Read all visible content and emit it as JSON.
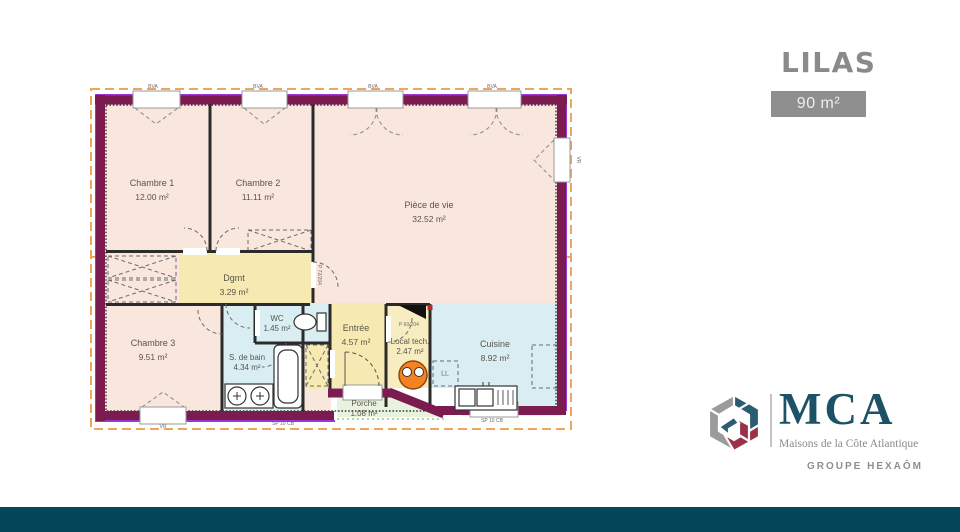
{
  "header": {
    "title": "LILAS",
    "area_badge": "90 m²"
  },
  "branding": {
    "name": "MCA",
    "tagline": "Maisons de la Côte Atlantique",
    "group": "GROUPE HEXAÔM"
  },
  "floorplan": {
    "rooms": [
      {
        "id": "chambre1",
        "name": "Chambre 1",
        "area": "12.00 m²"
      },
      {
        "id": "chambre2",
        "name": "Chambre 2",
        "area": "11.11 m²"
      },
      {
        "id": "piece-de-vie",
        "name": "Pièce de vie",
        "area": "32.52 m²"
      },
      {
        "id": "dgmt",
        "name": "Dgmt",
        "area": "3.29 m²"
      },
      {
        "id": "wc",
        "name": "WC",
        "area": "1.45 m²"
      },
      {
        "id": "chambre3",
        "name": "Chambre 3",
        "area": "9.51 m²"
      },
      {
        "id": "salle-de-bain",
        "name": "S. de bain",
        "area": "4.34 m²"
      },
      {
        "id": "entree",
        "name": "Entrée",
        "area": "4.57 m²"
      },
      {
        "id": "local-tech",
        "name": "Local tech.",
        "area": "2.47 m²"
      },
      {
        "id": "cuisine",
        "name": "Cuisine",
        "area": "8.92 m²"
      },
      {
        "id": "porche",
        "name": "Porche",
        "area": "1.08 m²"
      }
    ],
    "annotations": {
      "shutter": "BVA",
      "roller": "VR",
      "slab": "SP 10 CB",
      "door_size": "P 72/204",
      "door_size_small": "P 60/204",
      "washer": "LL"
    }
  },
  "colors": {
    "footer_teal": "#05465a",
    "title_gray": "#8a8a8a",
    "badge_bg": "#8f8f8f",
    "brand_blue": "#1d5266",
    "wall_maroon": "#7b1b50",
    "wall_outline_violet": "#9a35d8",
    "room_pink": "#f9e6dd",
    "room_yellow": "#f6eab2",
    "room_blue": "#d9eef3",
    "room_green": "#e7f3de",
    "section_orange": "#efa55b",
    "heater_orange": "#f58220"
  }
}
